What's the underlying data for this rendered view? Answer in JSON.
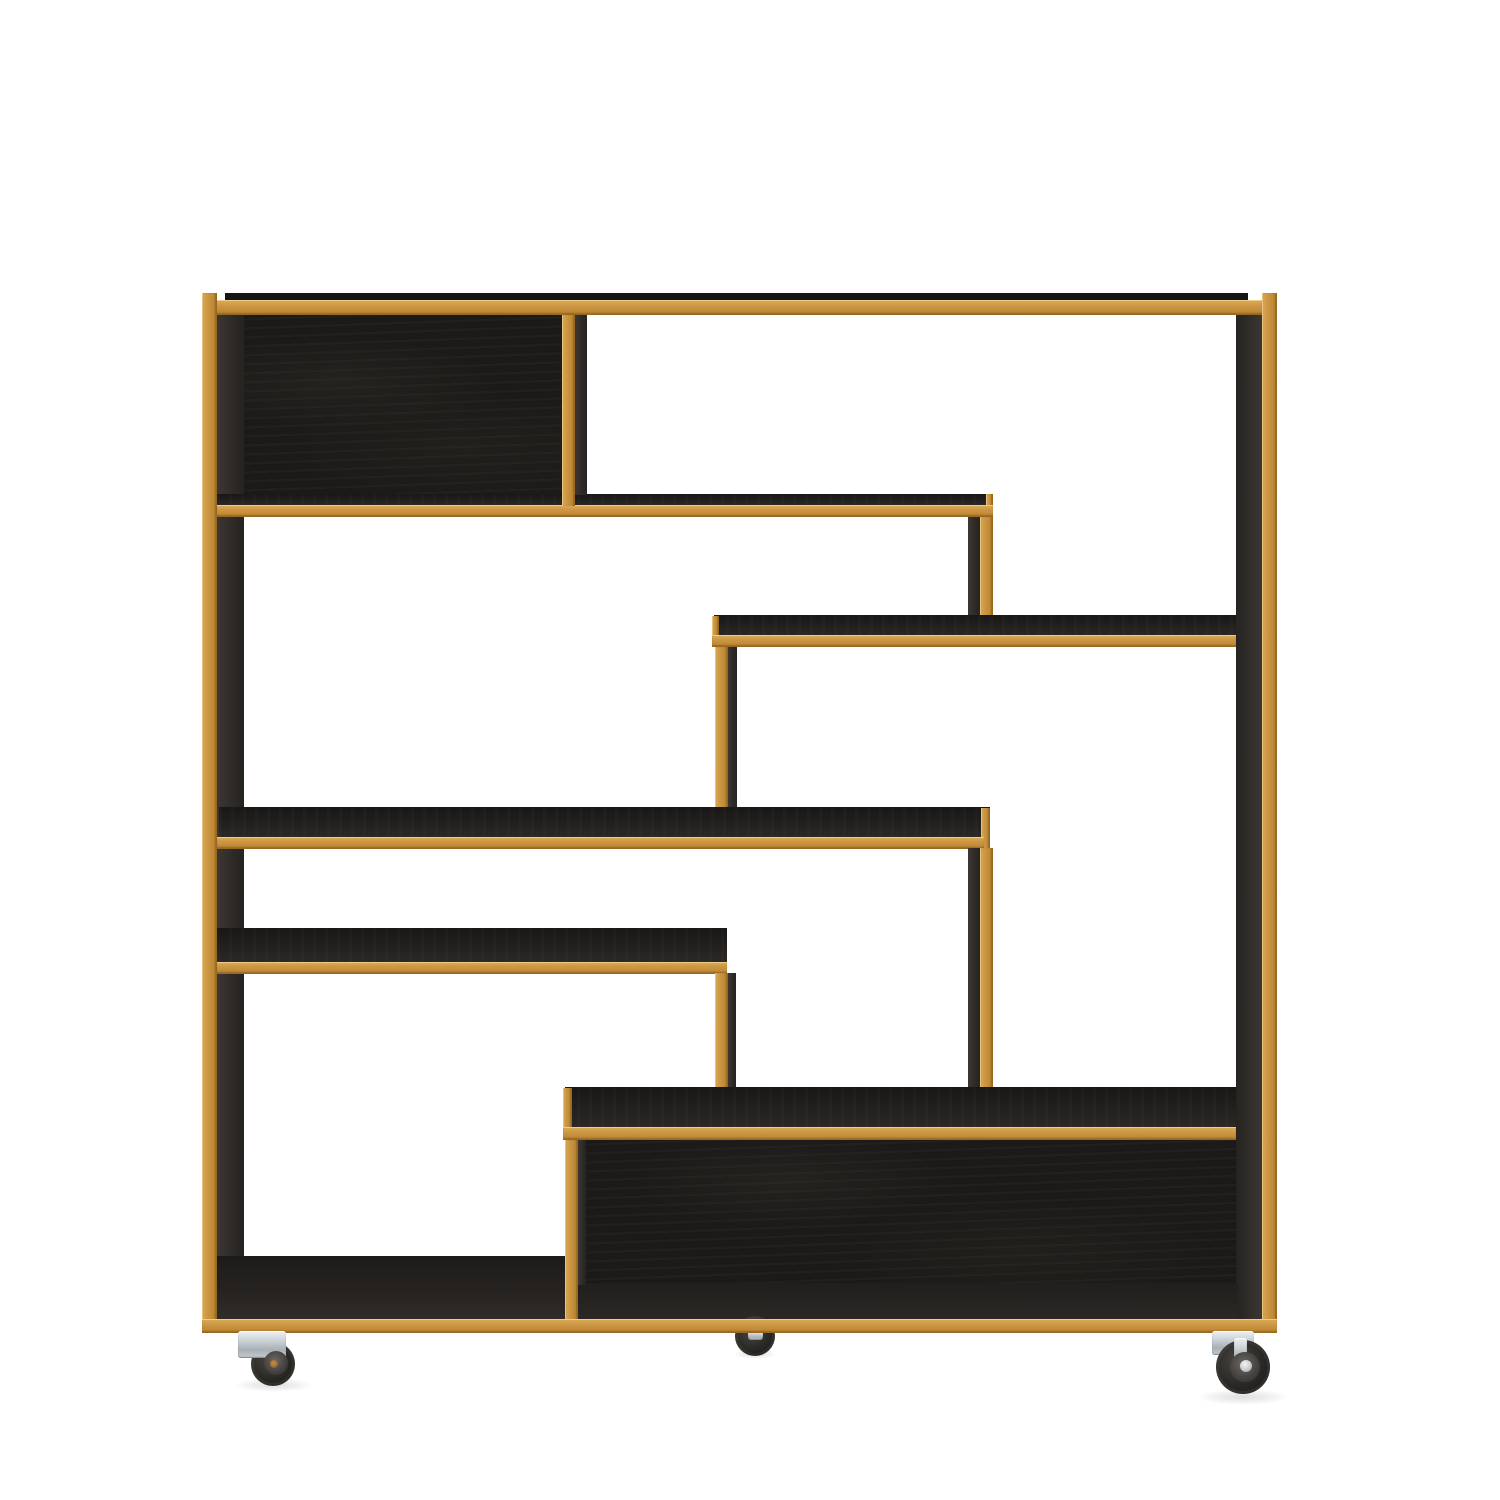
{
  "scene": {
    "description": "Studio product photograph, front view, of a modern rectangular shelving unit / bookcase room divider with an asymmetric staggered grid of shelves. Body is black-stained woodgrain; every front edge is finished with natural oak edge banding. The unit stands on swivel casters (two front, one rear visible) with chrome brackets and black tyres, on a pure white background. No text appears in the image.",
    "background_color": "#ffffff",
    "palette": {
      "background": "#ffffff",
      "oak_edge_light": "#d8a754",
      "oak_edge_mid": "#c89140",
      "oak_edge_dark": "#ad7b2c",
      "black_wood_back_panel": "#1b1a18",
      "black_wood_shelf_top": "#23211f",
      "black_wood_side_face": "#36312d",
      "caster_metal": "#c9cfd3",
      "caster_tire": "#2b2927",
      "caster_bolt_brass": "#a9743f"
    },
    "furniture": {
      "type": "staggered open shelving unit / bookcase room divider on casters",
      "orientation": "front elevation view",
      "outer_frame": "square carcass, oak-edged on all front edges",
      "compartments_with_black_back_panel": 2,
      "back_panel_positions": [
        "top left",
        "bottom right"
      ],
      "horizontal_shelves": 6,
      "vertical_dividers": 6,
      "open_bays": 7,
      "casters_visible": 3,
      "caster_style": "swivel wheel, chrome zinc bracket, black rubber tyre",
      "edge_material": "natural oak edge banding",
      "body_finish": "black stained oak woodgrain"
    },
    "elements": [
      {
        "name": "back-panel-top-left",
        "role": "back-panel",
        "x": 228,
        "y": 301,
        "w": 347,
        "h": 216
      },
      {
        "name": "back-panel-bottom",
        "role": "back-panel",
        "x": 572,
        "y": 1090,
        "w": 666,
        "h": 240
      },
      {
        "name": "left-panel-inner-face",
        "role": "side-face",
        "x": 217,
        "y": 300,
        "w": 27,
        "h": 1026
      },
      {
        "name": "right-panel-inner-face",
        "role": "side-face-r",
        "x": 1236,
        "y": 300,
        "w": 26,
        "h": 1026
      },
      {
        "name": "bottom-floor-left",
        "role": "floor",
        "x": 217,
        "y": 1256,
        "w": 361,
        "h": 66
      },
      {
        "name": "bottom-floor-inner",
        "role": "floor-inner",
        "x": 572,
        "y": 1283,
        "w": 666,
        "h": 38
      },
      {
        "name": "top-panel-top-surface",
        "role": "top-edge",
        "x": 225,
        "y": 293,
        "w": 1023,
        "h": 9
      },
      {
        "name": "top-frame-oak-edge",
        "role": "oak-h",
        "x": 202,
        "y": 300,
        "w": 1075,
        "h": 15
      },
      {
        "name": "left-panel-oak-edge",
        "role": "oak-v",
        "x": 202,
        "y": 293,
        "w": 15,
        "h": 1040
      },
      {
        "name": "right-panel-oak-edge",
        "role": "oak-v",
        "x": 1262,
        "y": 293,
        "w": 15,
        "h": 1040
      },
      {
        "name": "shelf-1-top-surface",
        "role": "dark-top",
        "x": 217,
        "y": 494,
        "w": 776,
        "h": 12
      },
      {
        "name": "shelf-1-end-cap",
        "role": "oak-v",
        "x": 986,
        "y": 494,
        "w": 7,
        "h": 12
      },
      {
        "name": "shelf-1-oak-edge",
        "role": "oak-h",
        "x": 217,
        "y": 505,
        "w": 776,
        "h": 12
      },
      {
        "name": "divider-top-left-oak-edge",
        "role": "oak-v",
        "x": 562,
        "y": 315,
        "w": 13,
        "h": 191
      },
      {
        "name": "divider-top-left-side-face",
        "role": "side-face",
        "x": 575,
        "y": 315,
        "w": 12,
        "h": 180
      },
      {
        "name": "divider-upper-middle-side-face",
        "role": "side-face",
        "x": 968,
        "y": 517,
        "w": 12,
        "h": 99
      },
      {
        "name": "divider-upper-middle-oak-edge",
        "role": "oak-v",
        "x": 980,
        "y": 517,
        "w": 13,
        "h": 130
      },
      {
        "name": "shelf-2-top-surface",
        "role": "dark-top",
        "x": 714,
        "y": 615,
        "w": 522,
        "h": 21
      },
      {
        "name": "shelf-2-end-cap",
        "role": "oak-v",
        "x": 712,
        "y": 616,
        "w": 7,
        "h": 20
      },
      {
        "name": "shelf-2-oak-edge",
        "role": "oak-h",
        "x": 712,
        "y": 635,
        "w": 524,
        "h": 12
      },
      {
        "name": "divider-middle-left-oak-edge",
        "role": "oak-v",
        "x": 715,
        "y": 647,
        "w": 13,
        "h": 191
      },
      {
        "name": "divider-middle-left-side-face",
        "role": "side-face",
        "x": 728,
        "y": 647,
        "w": 9,
        "h": 161
      },
      {
        "name": "shelf-3-top-surface",
        "role": "dark-top",
        "x": 219,
        "y": 807,
        "w": 771,
        "h": 31
      },
      {
        "name": "shelf-3-end-cap",
        "role": "oak-v",
        "x": 981,
        "y": 808,
        "w": 9,
        "h": 40
      },
      {
        "name": "shelf-3-oak-edge",
        "role": "oak-h",
        "x": 217,
        "y": 837,
        "w": 767,
        "h": 12
      },
      {
        "name": "divider-lower-middle-side-face",
        "role": "side-face",
        "x": 968,
        "y": 848,
        "w": 12,
        "h": 240
      },
      {
        "name": "divider-lower-middle-oak-edge",
        "role": "oak-v",
        "x": 980,
        "y": 848,
        "w": 13,
        "h": 280
      },
      {
        "name": "shelf-4-top-surface",
        "role": "dark-top",
        "x": 217,
        "y": 928,
        "w": 510,
        "h": 35
      },
      {
        "name": "shelf-4-oak-edge",
        "role": "oak-h",
        "x": 217,
        "y": 962,
        "w": 510,
        "h": 12
      },
      {
        "name": "divider-left-lower-oak-edge",
        "role": "oak-v",
        "x": 715,
        "y": 973,
        "w": 13,
        "h": 155
      },
      {
        "name": "divider-left-lower-side-face",
        "role": "side-face",
        "x": 728,
        "y": 973,
        "w": 8,
        "h": 115
      },
      {
        "name": "bottom-shelf-top-surface",
        "role": "dark-top",
        "x": 565,
        "y": 1087,
        "w": 671,
        "h": 41
      },
      {
        "name": "bottom-shelf-end-cap",
        "role": "oak-v",
        "x": 563,
        "y": 1088,
        "w": 9,
        "h": 50
      },
      {
        "name": "bottom-shelf-oak-edge",
        "role": "oak-h",
        "x": 563,
        "y": 1127,
        "w": 673,
        "h": 13
      },
      {
        "name": "divider-bottom-left-oak-edge",
        "role": "oak-v",
        "x": 565,
        "y": 1140,
        "w": 13,
        "h": 180
      },
      {
        "name": "divider-bottom-left-side-face",
        "role": "side-face",
        "x": 578,
        "y": 1140,
        "w": 8,
        "h": 145
      },
      {
        "name": "middle-caster-wheel",
        "role": "tire",
        "shape": "circle",
        "cx": 755,
        "cy": 1336,
        "r": 20
      },
      {
        "name": "middle-caster-fork",
        "role": "metal",
        "x": 748,
        "y": 1331,
        "w": 15,
        "h": 9
      },
      {
        "name": "bottom-frame-oak-edge",
        "role": "oak-h",
        "x": 202,
        "y": 1319,
        "w": 1075,
        "h": 14
      },
      {
        "name": "left-caster-shadow",
        "role": "shadow",
        "x": 234,
        "y": 1378,
        "w": 80,
        "h": 14
      },
      {
        "name": "middle-caster-shadow",
        "role": "shadow",
        "x": 733,
        "y": 1349,
        "w": 44,
        "h": 10
      },
      {
        "name": "right-caster-shadow",
        "role": "shadow",
        "x": 1196,
        "y": 1389,
        "w": 94,
        "h": 16
      },
      {
        "name": "left-caster-wheel",
        "role": "tire",
        "shape": "circle",
        "cx": 273,
        "cy": 1364,
        "r": 22
      },
      {
        "name": "left-caster-bracket",
        "role": "metal",
        "x": 238,
        "y": 1331,
        "w": 48,
        "h": 27
      },
      {
        "name": "left-caster-hub",
        "role": "hub",
        "shape": "circle",
        "cx": 276,
        "cy": 1363,
        "r": 12
      },
      {
        "name": "left-caster-bolt",
        "role": "bolt",
        "shape": "circle",
        "cx": 274,
        "cy": 1364,
        "r": 4
      },
      {
        "name": "right-caster-bracket",
        "role": "metal",
        "x": 1212,
        "y": 1331,
        "w": 42,
        "h": 24
      },
      {
        "name": "right-caster-wheel",
        "role": "tire",
        "shape": "circle",
        "cx": 1243,
        "cy": 1367,
        "r": 27
      },
      {
        "name": "right-caster-fork",
        "role": "metal",
        "x": 1234,
        "y": 1338,
        "w": 13,
        "h": 28
      },
      {
        "name": "right-caster-hub",
        "role": "hub",
        "shape": "circle",
        "cx": 1245,
        "cy": 1367,
        "r": 15
      },
      {
        "name": "right-caster-axle-cap",
        "role": "cap",
        "shape": "circle",
        "cx": 1246,
        "cy": 1366,
        "r": 6
      }
    ]
  }
}
